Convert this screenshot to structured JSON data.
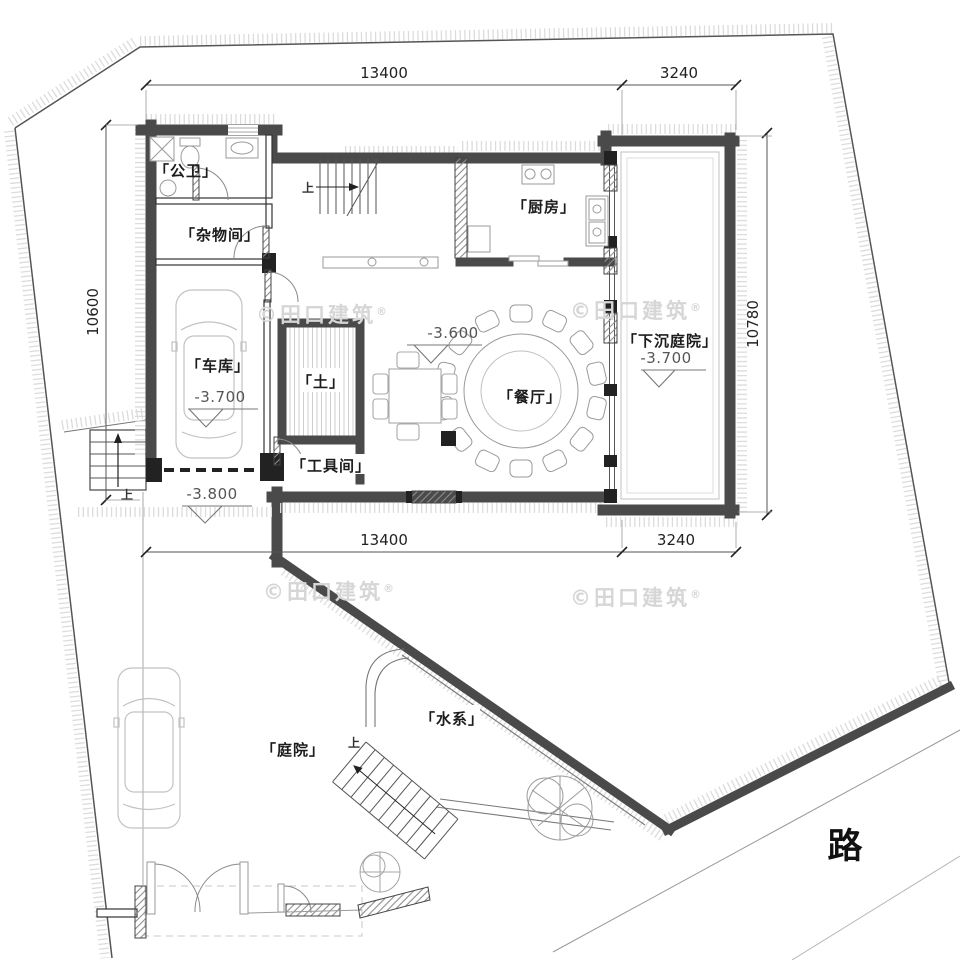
{
  "plan": {
    "dims": {
      "top_main": "13400",
      "top_secondary": "3240",
      "bottom_main": "13400",
      "bottom_secondary": "3240",
      "left": "10600",
      "right": "10780"
    },
    "rooms": {
      "public_wc": "「公卫」",
      "storage": "「杂物间」",
      "kitchen": "「厨房」",
      "garage": "「车库」",
      "soil": "「土」",
      "dining": "「餐厅」",
      "sunken_courtyard": "「下沉庭院」",
      "tool_room": "「工具间」",
      "water_feature": "「水系」",
      "courtyard": "「庭院」"
    },
    "levels": {
      "dining": "-3.600",
      "garage": "-3.700",
      "sunken_courtyard": "-3.700",
      "driveway": "-3.800"
    },
    "marks": {
      "up": "上",
      "road": "路"
    },
    "watermark": {
      "text": "©田口建筑",
      "reg": "®"
    }
  }
}
